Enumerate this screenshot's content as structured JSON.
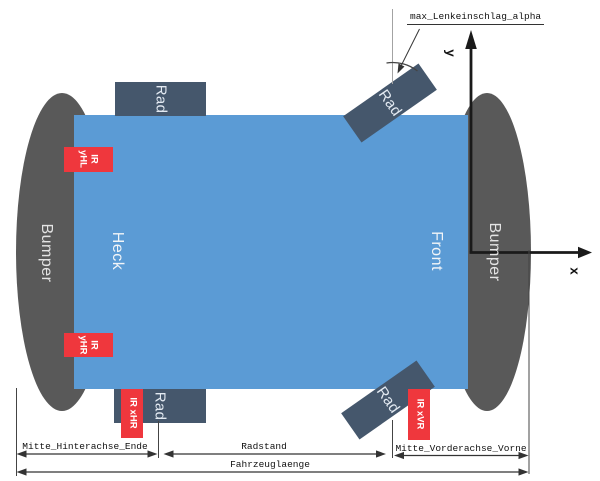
{
  "diagram": {
    "title_label": "max_Lenkeinschlag_alpha",
    "axes": {
      "x_label": "x",
      "y_label": "y"
    },
    "body": {
      "rear_label": "Heck",
      "front_label": "Front"
    },
    "bumper_label": "Bumper",
    "wheel_label": "Rad",
    "sensors": {
      "yHL": {
        "line1": "IR",
        "line2": "yHL"
      },
      "yHR": {
        "line1": "IR",
        "line2": "yHR"
      },
      "xHR": {
        "label": "IR xHR"
      },
      "xVR": {
        "label": "IR xVR"
      }
    },
    "dimensions": {
      "rear_overhang": "Mitte_Hinterachse_Ende",
      "wheelbase": "Radstand",
      "front_overhang": "Mitte_Vorderachse_Vorne",
      "vehicle_length": "Fahrzeuglaenge"
    },
    "colors": {
      "body": "#5b9bd5",
      "wheel": "#45576c",
      "sensor": "#ef373d",
      "bumper": "#595959",
      "line": "#222222"
    }
  }
}
